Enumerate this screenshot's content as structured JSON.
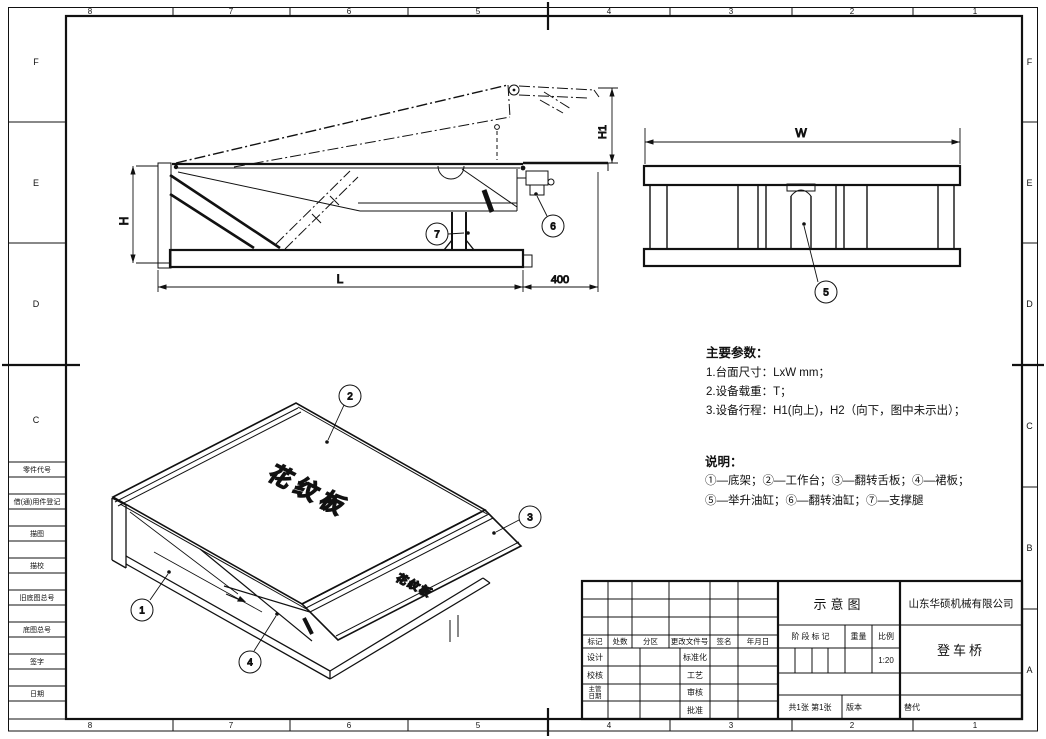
{
  "sheet": {
    "zone_columns": [
      "8",
      "7",
      "6",
      "5",
      "4",
      "3",
      "2",
      "1"
    ],
    "zone_rows": [
      "F",
      "E",
      "D",
      "C",
      "B",
      "A"
    ],
    "margin_labels": [
      "零件代号",
      "借(通)用件登记",
      "描图",
      "描校",
      "旧底图总号",
      "底图总号",
      "签字",
      "日期"
    ]
  },
  "views": {
    "plate_label_top": "花纹板",
    "plate_label_lip": "花纹板"
  },
  "dimensions": {
    "h": "H",
    "h1": "H1",
    "l": "L",
    "offset_400": "400",
    "w": "W"
  },
  "balloons": {
    "b1": "1",
    "b2": "2",
    "b3": "3",
    "b4": "4",
    "b5": "5",
    "b6": "6",
    "b7": "7"
  },
  "notes": {
    "params_title": "主要参数：",
    "params": [
      "1.台面尺寸：LxW mm；",
      "2.设备载重：T；",
      "3.设备行程：H1(向上)，H2（向下，图中未示出）；"
    ],
    "legend_title": "说明：",
    "legend_lines": [
      "①—底架；②—工作台；③—翻转舌板；④—裙板；",
      "⑤—举升油缸；⑥—翻转油缸；⑦—支撑腿"
    ]
  },
  "title_block": {
    "doc_type": "示意图",
    "company": "山东华硕机械有限公司",
    "part_name": "登车桥",
    "change_headers": [
      "标记",
      "处数",
      "分区",
      "更改文件号",
      "签名",
      "年月日"
    ],
    "sign_labels_left": [
      "设计",
      "校核",
      "主管",
      "日期"
    ],
    "sign_labels_mid": [
      "标准化",
      "工艺",
      "审核",
      "批准"
    ],
    "stage_label": "阶段标记",
    "weight_label": "重量",
    "scale_label": "比例",
    "scale_value": "1:20",
    "sheet_info": "共1张 第1张",
    "version_label": "版本",
    "replace_label": "替代"
  }
}
